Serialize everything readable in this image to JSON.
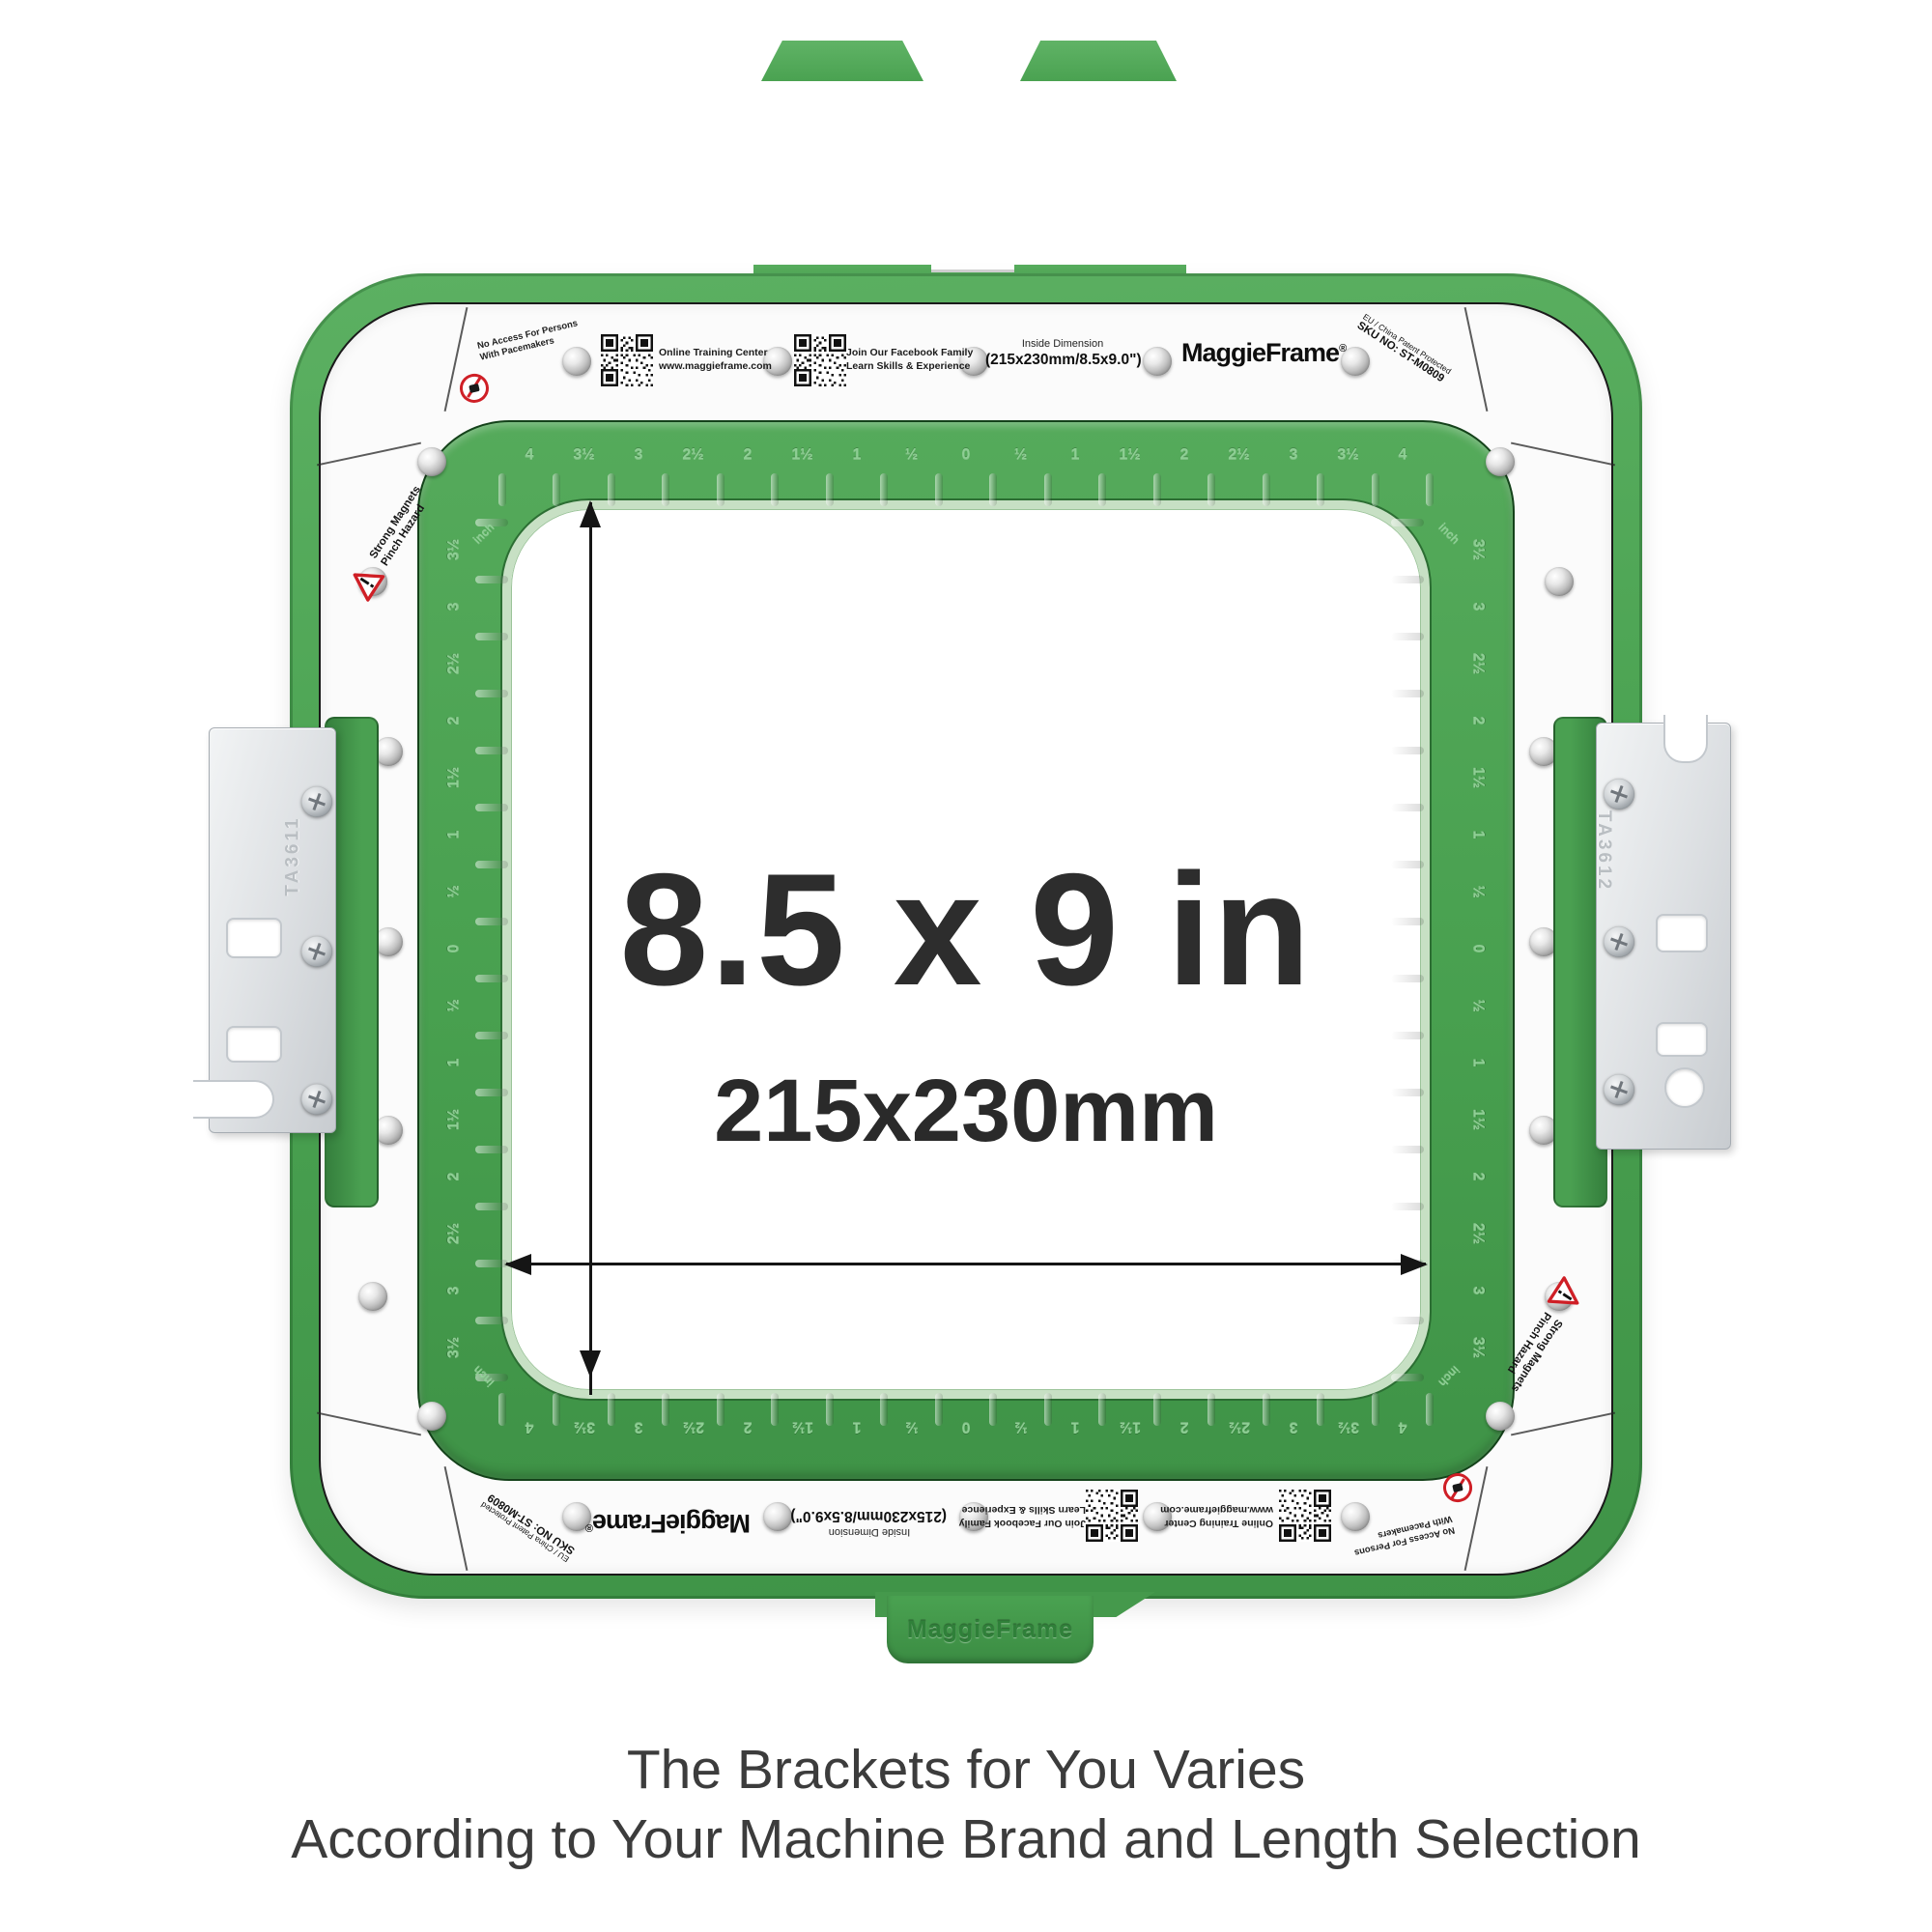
{
  "title": {
    "size_in": "8.5 x 9 in",
    "size_mm": "215x230mm"
  },
  "band": {
    "training_line1": "Online Training Center",
    "training_line2": "www.maggieframe.com",
    "facebook_line1": "Join Our Facebook Family",
    "facebook_line2": "Learn Skills & Experience",
    "inside_dim_title": "Inside Dimension",
    "inside_dim_value": "(215x230mm/8.5x9.0\")",
    "brand": "MaggieFrame",
    "brand_reg": "®",
    "patent": "EU / China Patent Protected",
    "sku": "SKU NO: ST-M0809",
    "pacemaker_line1": "No Access For Persons",
    "pacemaker_line2": "With Pacemakers",
    "magnets_line1": "Strong Magnets",
    "magnets_line2": "Pinch Hazard"
  },
  "brackets": {
    "left_code": "TA3611",
    "right_code": "TA3612"
  },
  "emboss": {
    "tab_brand": "MaggieFrame",
    "ruler_unit": "inch"
  },
  "rulers": {
    "row": [
      "4",
      "3½",
      "3",
      "2½",
      "2",
      "1½",
      "1",
      "½",
      "0",
      "½",
      "1",
      "1½",
      "2",
      "2½",
      "3",
      "3½",
      "4"
    ],
    "col": [
      "3½",
      "3",
      "2½",
      "2",
      "1½",
      "1",
      "½",
      "0",
      "½",
      "1",
      "1½",
      "2",
      "2½",
      "3",
      "3½"
    ]
  },
  "caption": {
    "line1": "The Brackets for You Varies",
    "line2": "According to Your Machine Brand and Length Selection"
  },
  "colors": {
    "frame_green": "#4aa051",
    "band_white": "#fbfbfb",
    "warning_red": "#cf1f26",
    "text_dark": "#2d2d2d"
  }
}
